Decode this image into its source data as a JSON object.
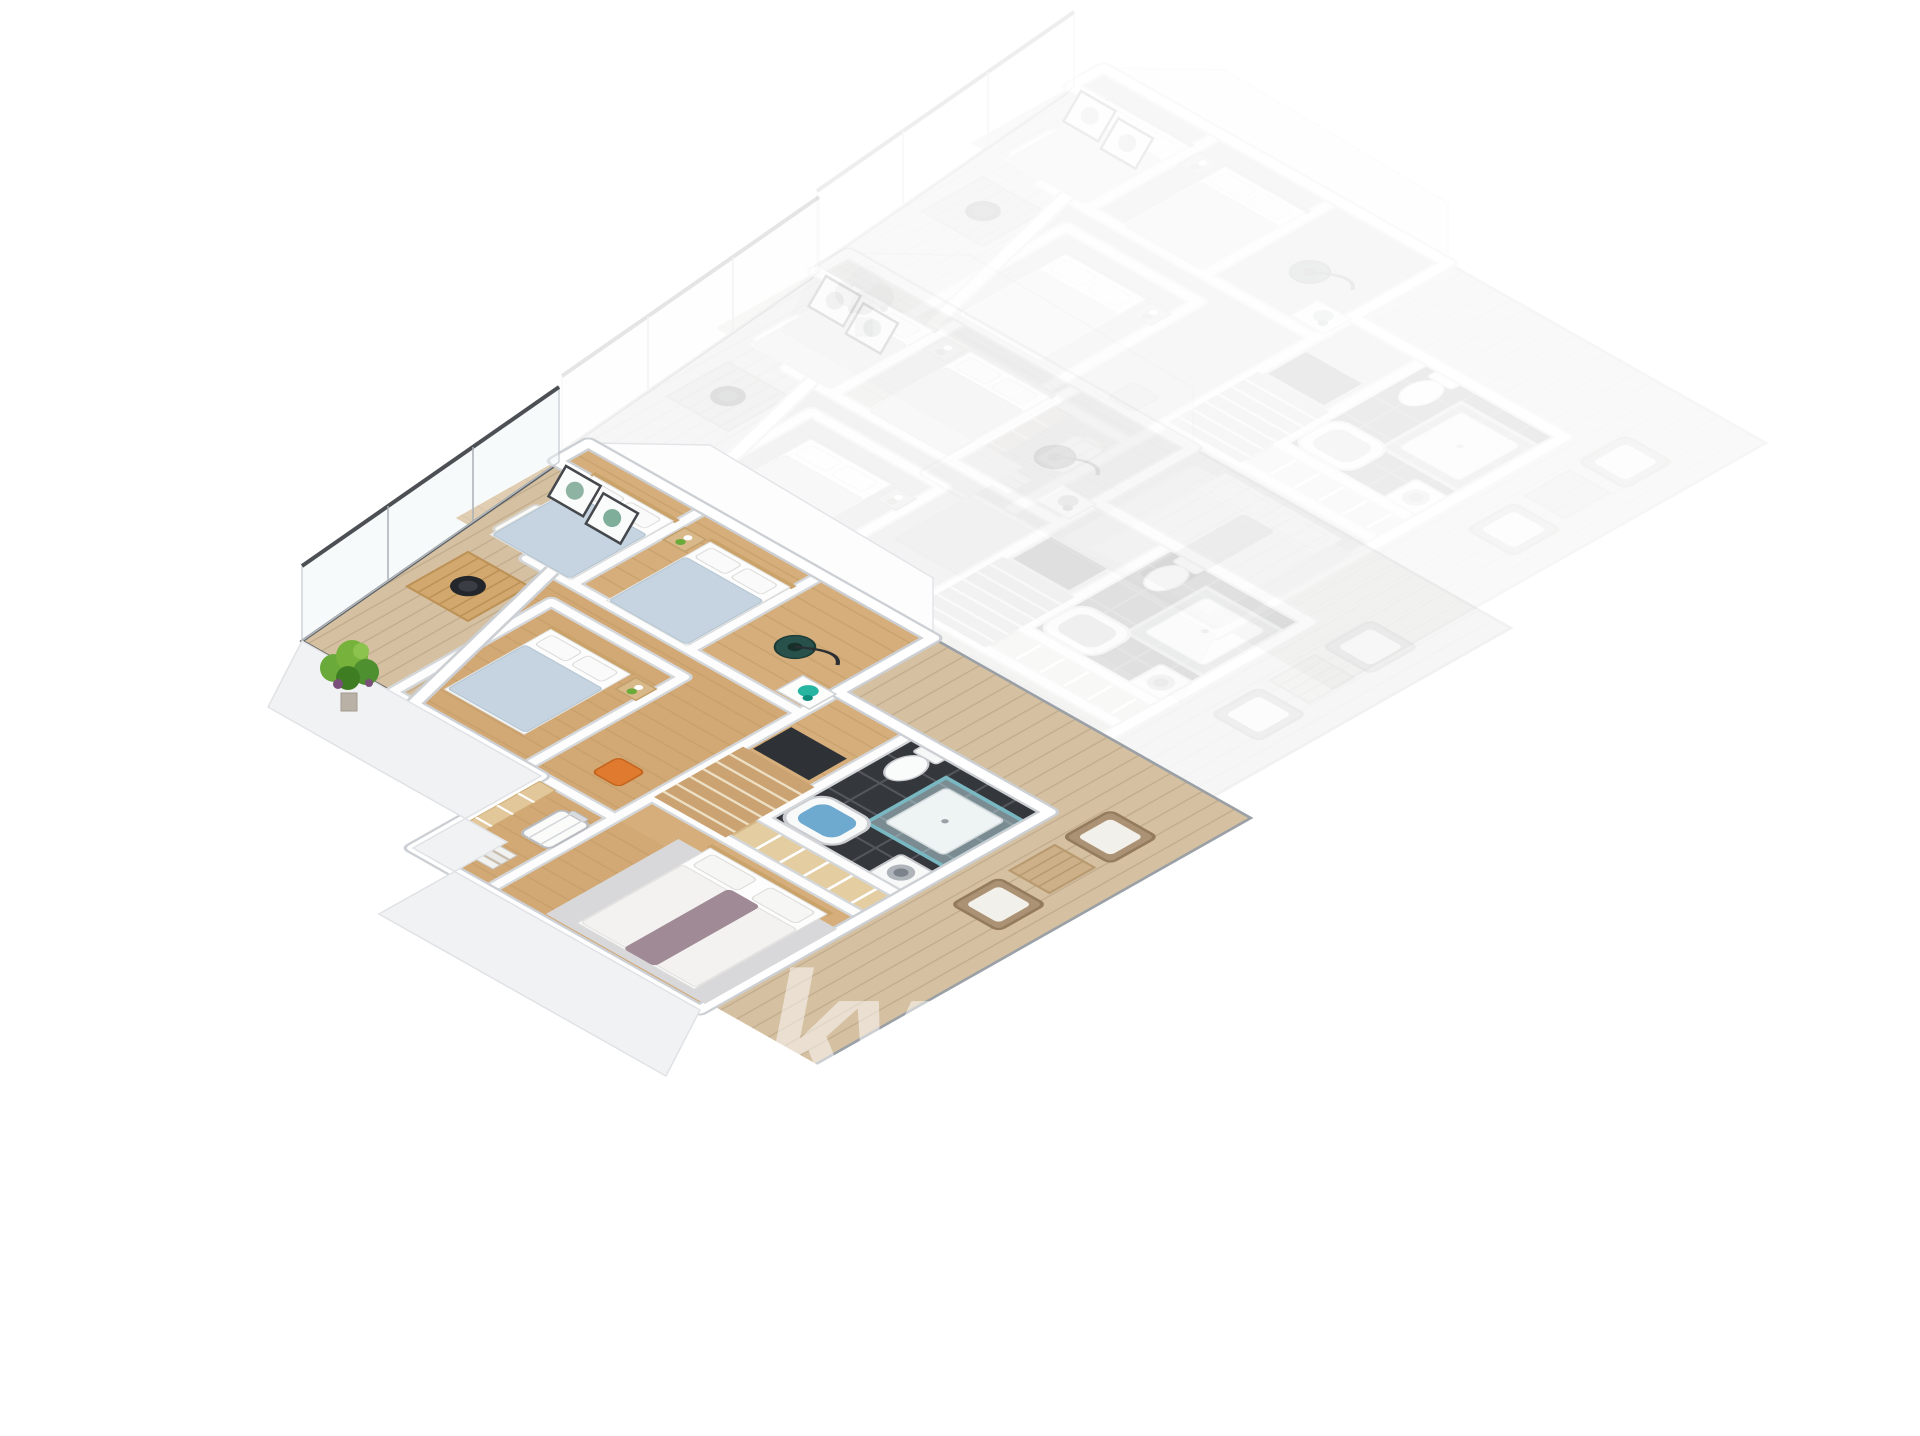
{
  "canvas": {
    "width": 1920,
    "height": 1436,
    "background": "#ffffff"
  },
  "watermark": {
    "monogram": "kw",
    "region_line1": "CZECH",
    "region_line2": "REPUBLIC",
    "brand": "KELLERWILLIAMS",
    "color": "#ffffff",
    "opacity": 0.5
  },
  "palette": {
    "wall": "#ffffff",
    "wall_shade": "#f1f2f4",
    "outline": "#ccd0d4",
    "floor_wood": "#d6ae7b",
    "floor_wood_line": "#c09a66",
    "deck_wood": "#d5c0a1",
    "deck_wood_line": "#bda88a",
    "bath_tile": "#34373c",
    "bath_tile_line": "#54575d",
    "glass_shower": "#bfe0e6",
    "glass_frame": "#4c5054",
    "bath_water": "#6ea9cf",
    "bedding_blue": "#c5d4e0",
    "master_runner": "#a08a95",
    "rug": "#d8d8da",
    "wicker": "#ab9274",
    "cushion": "#f2f0ea",
    "table_wood": "#d2a86e",
    "plant_green": "#6aaa3a",
    "plant_green_dark": "#3f7d22",
    "accent_chair_orange": "#e07a2e",
    "vacuum_green": "#27514a",
    "box_teal": "#27b5a2",
    "ghost_opacity_near": 0.14,
    "ghost_opacity_far": 0.09
  },
  "scene": {
    "type": "isometric-3d-floor-plan",
    "highlighted_units": 1,
    "ghost_units": 2,
    "rooms": [
      "upper-terrace",
      "bedroom-1",
      "bedroom-2",
      "storage-room",
      "bedroom-3",
      "hallway",
      "landing-stairs",
      "bathroom",
      "wardrobe",
      "master-bedroom",
      "walk-in-closet",
      "lower-terrace"
    ],
    "furniture": [
      "terrace-bench",
      "terrace-coffee-table",
      "decor-bowl",
      "potted-plant",
      "single-bed",
      "single-bed",
      "single-bed",
      "nightstand",
      "wall-art",
      "vacuum-cleaner",
      "storage-box",
      "toilet",
      "glass-shower",
      "washing-machine",
      "bathtub",
      "double-bed",
      "area-rug",
      "suitcase",
      "closet-shelves",
      "books",
      "accent-chair",
      "wicker-armchair",
      "wicker-armchair",
      "deck-table",
      "stair-hatch"
    ]
  }
}
